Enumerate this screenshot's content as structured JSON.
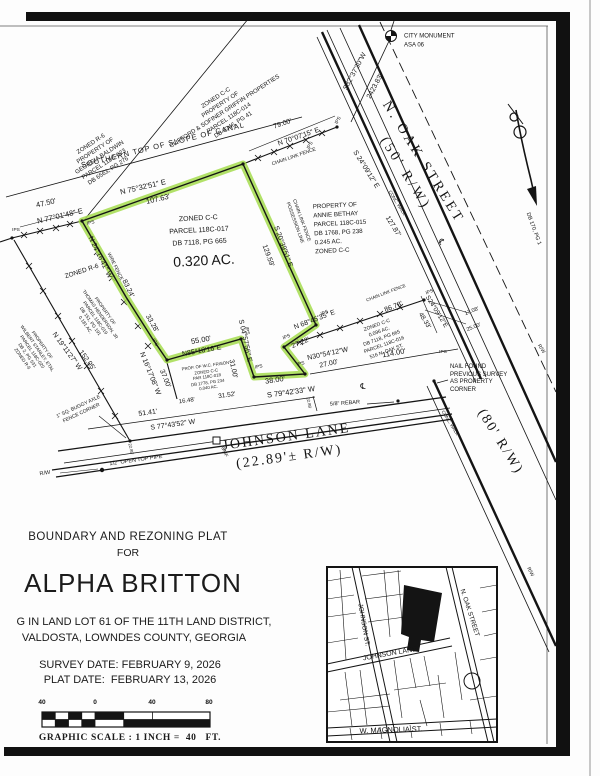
{
  "title_block": {
    "line1": "BOUNDARY AND REZONING PLAT",
    "line2": "FOR",
    "name": "ALPHA BRITTON",
    "desc1": "G IN LAND LOT 61 OF THE 11TH LAND DISTRICT,",
    "desc2": "VALDOSTA, LOWNDES COUNTY, GEORGIA",
    "survey_date": "SURVEY DATE: FEBRUARY 9, 2026",
    "plat_date": "PLAT DATE:  FEBRUARY 13, 2026"
  },
  "scale_bar": {
    "ticks": [
      "40",
      "0",
      "40",
      "80"
    ],
    "caption": "GRAPHIC SCALE : 1 INCH =  40   FT."
  },
  "colors": {
    "highlight": "#a4dc4e",
    "ink": "#141414"
  },
  "subject_parcel": {
    "area": "0.320 AC.",
    "parcel": "PARCEL 118C-017",
    "zoning": "ZONED C-C"
  },
  "map_labels": [
    {
      "t": "CITY MONUMENT",
      "x": 404,
      "y": 37,
      "r": 0,
      "s": 6,
      "a": "left",
      "n": "city-monument-label"
    },
    {
      "t": "ASA 06",
      "x": 404,
      "y": 46,
      "r": 0,
      "s": 6,
      "a": "left",
      "n": "city-monument-id"
    },
    {
      "t": "S32°37'30\"W",
      "x": 356,
      "y": 72,
      "r": -62,
      "s": 7
    },
    {
      "t": "2423.83'",
      "x": 376,
      "y": 87,
      "r": -62,
      "s": 7
    },
    {
      "t": [
        "N. OAK STREET",
        "(50' R/W)"
      ],
      "x": 414,
      "y": 168,
      "r": 58,
      "s": 14,
      "f": "serif",
      "ls": 3,
      "lh": 1.5,
      "n": "street-label-n-oak-street"
    },
    {
      "t": "(80' R/W)",
      "x": 500,
      "y": 442,
      "r": 58,
      "s": 14,
      "f": "serif",
      "ls": 2,
      "n": "street-label-80-rw"
    },
    {
      "t": [
        "JOHNSON LANE",
        "(22.89'± R/W)"
      ],
      "x": 288,
      "y": 448,
      "r": -8,
      "s": 14,
      "f": "serif",
      "ls": 2,
      "lh": 1.45,
      "n": "street-label-johnson-lane"
    },
    {
      "t": [
        "ZONED C-C",
        "PROPERTY OF",
        "CLIFFORD & SOFINER GRIFFIN PROPERTIES",
        "PARCEL 118C-014",
        "DB 3346, PG 41"
      ],
      "x": 225,
      "y": 112,
      "r": -33,
      "s": 6,
      "lh": 1.35,
      "n": "parcel-label-118c-014"
    },
    {
      "t": [
        "ZONED R-6",
        "PROPERTY OF",
        "GEORGIA BALDWIN",
        "PARCEL 118C-023",
        "DB 6563, PG 276"
      ],
      "x": 100,
      "y": 158,
      "r": -33,
      "s": 6,
      "lh": 1.35,
      "n": "parcel-label-118c-023"
    },
    {
      "t": "SOUTHERN TOP OF SLOPE OF CANAL",
      "x": 163,
      "y": 145,
      "r": -14,
      "s": 7.5,
      "ls": 1,
      "n": "canal-label"
    },
    {
      "t": "79.00'",
      "x": 283,
      "y": 125,
      "r": -19,
      "s": 7
    },
    {
      "t": "N 70°07'15\" E",
      "x": 299,
      "y": 138,
      "r": -19,
      "s": 7
    },
    {
      "t": "CHAIN LINK FENCE",
      "x": 294,
      "y": 157,
      "r": -19,
      "s": 5
    },
    {
      "t": "47.50'",
      "x": 46,
      "y": 203,
      "r": -13,
      "s": 7.5
    },
    {
      "t": "N 77°01'48\" E",
      "x": 60,
      "y": 216,
      "r": -13,
      "s": 7.5
    },
    {
      "t": "N 75°32'51\" E",
      "x": 143,
      "y": 187,
      "r": -13,
      "s": 7.5
    },
    {
      "t": "107.63'",
      "x": 158,
      "y": 199,
      "r": -13,
      "s": 7.5
    },
    {
      "t": "N 24°16'41\" W",
      "x": 99,
      "y": 258,
      "r": 64,
      "s": 7
    },
    {
      "t": "WIRE FENCE",
      "x": 114,
      "y": 267,
      "r": 64,
      "s": 4.8
    },
    {
      "t": "83.24'",
      "x": 127,
      "y": 289,
      "r": 64,
      "s": 7
    },
    {
      "t": "33.28'",
      "x": 151,
      "y": 324,
      "r": 60,
      "s": 7
    },
    {
      "t": "N 16°17'08\" W",
      "x": 149,
      "y": 374,
      "r": 68,
      "s": 7
    },
    {
      "t": "37.00'",
      "x": 164,
      "y": 379,
      "r": 68,
      "s": 7
    },
    {
      "t": "ZONED R-6",
      "x": 82,
      "y": 272,
      "r": -18,
      "s": 6.5
    },
    {
      "t": [
        "PROPERTY OF",
        "THOMAS HENDERSON, JR",
        "PARCEL 118C-019",
        "DB 151, PG 191",
        "0.181 AC."
      ],
      "x": 95,
      "y": 318,
      "r": 55,
      "s": 4.6,
      "lh": 1.3,
      "n": "parcel-label-118c-019"
    },
    {
      "t": [
        "PROPERTY OF",
        "WILBERT STANLEY, ETAL",
        "PARCEL 118C-020",
        "DB 2, PG 531",
        "ZONED R-6"
      ],
      "x": 32,
      "y": 352,
      "r": 55,
      "s": 4.6,
      "lh": 1.3,
      "n": "parcel-label-118c-020"
    },
    {
      "t": "N 19°11'27\" W",
      "x": 66,
      "y": 352,
      "r": 54,
      "s": 7
    },
    {
      "t": "152.05'",
      "x": 86,
      "y": 361,
      "r": 54,
      "s": 7
    },
    {
      "t": [
        "1\" SQ. BUGGY AXLE",
        "FENCE CORNER"
      ],
      "x": 80,
      "y": 410,
      "r": -25,
      "s": 5,
      "lh": 1.3,
      "n": "buggy-axle-note"
    },
    {
      "t": [
        "ZONED C-C",
        "PARCEL 118C-017",
        "DB 7118, PG 665"
      ],
      "x": 199,
      "y": 231,
      "r": -3,
      "s": 7,
      "lh": 1.7,
      "n": "parcel-label-118c-017"
    },
    {
      "t": "0.320 AC.",
      "x": 204,
      "y": 261,
      "r": -3,
      "s": 14,
      "n": "subject-parcel-area"
    },
    {
      "t": [
        "PROPERTY OF",
        "ANNIE BETHAY",
        "PARCEL 118C-015",
        "DB 1768, PG 238",
        "0.245 AC.",
        "ZONED C-C"
      ],
      "x": 314,
      "y": 229,
      "r": -3,
      "s": 6.2,
      "lh": 1.45,
      "a": "left",
      "n": "parcel-label-118c-015"
    },
    {
      "t": [
        "CHAIN LINK FENCE",
        "POSSESSION LINE"
      ],
      "x": 297,
      "y": 222,
      "r": 70,
      "s": 4.8,
      "lh": 1.4
    },
    {
      "t": "S 20°39'51\" E",
      "x": 282,
      "y": 247,
      "r": 70,
      "s": 7
    },
    {
      "t": "129.59'",
      "x": 267,
      "y": 256,
      "r": 70,
      "s": 7
    },
    {
      "t": "S 24°09'12\" E",
      "x": 365,
      "y": 170,
      "r": 58,
      "s": 7
    },
    {
      "t": "127.87'",
      "x": 392,
      "y": 227,
      "r": 58,
      "s": 7
    },
    {
      "t": "CONC. WALK",
      "x": 397,
      "y": 203,
      "r": 58,
      "s": 4.5
    },
    {
      "t": "CONC. WALK",
      "x": 450,
      "y": 423,
      "r": 58,
      "s": 4.5
    },
    {
      "t": "S24°09'12\"E",
      "x": 436,
      "y": 312,
      "r": 58,
      "s": 6.5
    },
    {
      "t": "48.33'",
      "x": 424,
      "y": 321,
      "r": 58,
      "s": 6.5
    },
    {
      "t": "17.08'",
      "x": 472,
      "y": 312,
      "r": -22,
      "s": 5.5
    },
    {
      "t": "25.00'",
      "x": 474,
      "y": 328,
      "r": -22,
      "s": 5.5
    },
    {
      "t": "N 68°45'35\" E",
      "x": 315,
      "y": 321,
      "r": -21,
      "s": 7
    },
    {
      "t": "CHAIN LINK FENCE",
      "x": 386,
      "y": 293,
      "r": -21,
      "s": 4.5
    },
    {
      "t": "86.78'",
      "x": 394,
      "y": 308,
      "r": -21,
      "s": 7
    },
    {
      "t": [
        "ZONED C-C",
        "0.096 AC.",
        "DB 7118, PG 665",
        "PARCEL 118C-016",
        "516 N. OAK ST."
      ],
      "x": 382,
      "y": 339,
      "r": -20,
      "s": 5,
      "lh": 1.4,
      "n": "parcel-label-118c-016"
    },
    {
      "t": "27.22'",
      "x": 301,
      "y": 344,
      "r": -22,
      "s": 7
    },
    {
      "t": "N30°54'12\"W",
      "x": 328,
      "y": 355,
      "r": -12,
      "s": 7
    },
    {
      "t": "27.00'",
      "x": 329,
      "y": 365,
      "r": -12,
      "s": 7
    },
    {
      "t": "114.00'",
      "x": 394,
      "y": 353,
      "r": -10,
      "s": 7.5
    },
    {
      "t": "S 04°57'56\" E",
      "x": 244,
      "y": 341,
      "r": 78,
      "s": 7
    },
    {
      "t": "31.00'",
      "x": 232,
      "y": 369,
      "r": 78,
      "s": 7
    },
    {
      "t": "55.00'",
      "x": 201,
      "y": 340,
      "r": -10,
      "s": 7.5
    },
    {
      "t": "N85°18'16\"E",
      "x": 202,
      "y": 352,
      "r": -10,
      "s": 7
    },
    {
      "t": [
        "PROP. OF W.C. FRISON",
        "ZONED C-C",
        "PAR 118C-018",
        "DB 1778, PG 234",
        "0.040 AC."
      ],
      "x": 207,
      "y": 377,
      "r": -8,
      "s": 4.3,
      "lh": 1.3,
      "n": "parcel-label-118c-018"
    },
    {
      "t": "38.00'",
      "x": 275,
      "y": 380,
      "r": -8,
      "s": 7.5
    },
    {
      "t": "S 79°42'33\" W",
      "x": 291,
      "y": 392,
      "r": -8,
      "s": 7.5
    },
    {
      "t": "℄",
      "x": 363,
      "y": 387,
      "r": 0,
      "s": 8,
      "n": "centerline-symbol"
    },
    {
      "t": "℄",
      "x": 441,
      "y": 242,
      "r": 58,
      "s": 8,
      "n": "centerline-symbol"
    },
    {
      "t": "16.48'",
      "x": 187,
      "y": 402,
      "r": -8,
      "s": 6
    },
    {
      "t": "31.52'",
      "x": 227,
      "y": 396,
      "r": -8,
      "s": 6.5
    },
    {
      "t": "51.41'",
      "x": 148,
      "y": 414,
      "r": -8,
      "s": 7
    },
    {
      "t": "S 77°43'52\" W",
      "x": 173,
      "y": 426,
      "r": -8,
      "s": 7
    },
    {
      "t": "CMF",
      "x": 224,
      "y": 452,
      "r": 68,
      "s": 5
    },
    {
      "t": "1/2\" OPEN TOP PIPE",
      "x": 136,
      "y": 461,
      "r": -8,
      "s": 5.5
    },
    {
      "t": "R/W",
      "x": 45,
      "y": 474,
      "r": -8,
      "s": 5.5
    },
    {
      "t": "5/8\" REBAR",
      "x": 345,
      "y": 404,
      "r": -4,
      "s": 5.5
    },
    {
      "t": [
        "NAIL FOUND",
        "PREVIOUS SURVEY",
        "AS PROPERTY",
        "CORNER"
      ],
      "x": 450,
      "y": 379,
      "r": 0,
      "s": 6,
      "lh": 1.25,
      "a": "left",
      "n": "nail-found-note"
    },
    {
      "t": "R/W",
      "x": 541,
      "y": 349,
      "r": 58,
      "s": 5
    },
    {
      "t": "R/W",
      "x": 530,
      "y": 572,
      "r": 62,
      "s": 5
    },
    {
      "t": "DB 170, PG 1",
      "x": 533,
      "y": 229,
      "r": 70,
      "s": 5.5
    },
    {
      "t": "22.89'",
      "x": 309,
      "y": 403,
      "r": 78,
      "s": 4.2
    },
    {
      "t": "22.89'",
      "x": 131,
      "y": 449,
      "r": 78,
      "s": 4.2
    },
    {
      "t": "IPS",
      "x": 16,
      "y": 231,
      "r": 0,
      "s": 4.8
    },
    {
      "t": "IPS",
      "x": 91,
      "y": 224,
      "r": -13,
      "s": 4.8
    },
    {
      "t": "IPS",
      "x": 311,
      "y": 146,
      "r": -62,
      "s": 4.8
    },
    {
      "t": "IPS",
      "x": 339,
      "y": 121,
      "r": -62,
      "s": 4.8
    },
    {
      "t": "IPS",
      "x": 154,
      "y": 343,
      "r": 60,
      "s": 4.8
    },
    {
      "t": "IPS",
      "x": 246,
      "y": 331,
      "r": 80,
      "s": 4.8
    },
    {
      "t": "IPS",
      "x": 259,
      "y": 368,
      "r": -12,
      "s": 4.8
    },
    {
      "t": "IPS",
      "x": 301,
      "y": 365,
      "r": -12,
      "s": 4.8
    },
    {
      "t": "IPS",
      "x": 325,
      "y": 314,
      "r": -22,
      "s": 4.8
    },
    {
      "t": "IPS",
      "x": 287,
      "y": 338,
      "r": -22,
      "s": 4.8
    },
    {
      "t": "IPS",
      "x": 430,
      "y": 293,
      "r": -22,
      "s": 4.8
    },
    {
      "t": "IPS",
      "x": 443,
      "y": 353,
      "r": 0,
      "s": 4.8
    },
    {
      "t": "JOHNSON ST.",
      "x": 363,
      "y": 625,
      "r": 80,
      "s": 6.5,
      "n": "vicinity-street-johnson-st"
    },
    {
      "t": "N. OAK STREET",
      "x": 469,
      "y": 613,
      "r": 72,
      "s": 6.5,
      "n": "vicinity-street-n-oak"
    },
    {
      "t": "JOHNSON LANE",
      "x": 390,
      "y": 655,
      "r": -10,
      "s": 7,
      "n": "vicinity-street-johnson-lane"
    },
    {
      "t": "W. MAGNOLIA ST.",
      "x": 391,
      "y": 730,
      "r": -2,
      "s": 7.5,
      "n": "vicinity-street-w-magnolia"
    }
  ]
}
